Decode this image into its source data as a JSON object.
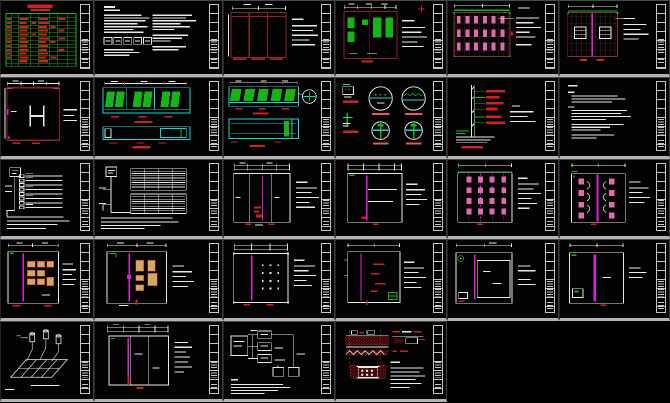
{
  "canvas": {
    "background": "#000000",
    "separator": "#b3b3b3",
    "cell_border": "#c6c6c6"
  },
  "palette": {
    "green": "#16b416",
    "red": "#d22020",
    "lightred": "#e8566a",
    "darkred": "#8a2424",
    "brown": "#7c3434",
    "pink": "#e06bb0",
    "magenta": "#e020d8",
    "cyan": "#1ad4d4",
    "tan": "#cfa968",
    "white": "#e8e8e8",
    "gray": "#c2c2c2",
    "sep": "#b3b3b3"
  },
  "sheets": [
    {
      "id": "r1c1",
      "name": "drawing-list-table",
      "kind": "table"
    },
    {
      "id": "r1c2",
      "name": "general-notes-sheet",
      "kind": "notes"
    },
    {
      "id": "r1c3",
      "name": "door-elevation",
      "kind": "elevation"
    },
    {
      "id": "r1c4",
      "name": "plan-with-green-fixtures",
      "kind": "plan"
    },
    {
      "id": "r1c5",
      "name": "ceiling-grid-plan-a",
      "kind": "ceiling"
    },
    {
      "id": "r1c6",
      "name": "ceiling-grid-plan-b",
      "kind": "ceiling"
    },
    {
      "id": "r2c1",
      "name": "room-plan-detail",
      "kind": "plan"
    },
    {
      "id": "r2c2",
      "name": "storefront-elevation-pair-a",
      "kind": "elevation"
    },
    {
      "id": "r2c3",
      "name": "storefront-elevation-pair-b",
      "kind": "elevation"
    },
    {
      "id": "r2c4",
      "name": "node-detail-circles",
      "kind": "detail"
    },
    {
      "id": "r2c5",
      "name": "wall-section-detail",
      "kind": "section"
    },
    {
      "id": "r2c6",
      "name": "specification-notes",
      "kind": "notes"
    },
    {
      "id": "r3c1",
      "name": "riser-diagram-a",
      "kind": "diagram"
    },
    {
      "id": "r3c2",
      "name": "riser-diagram-b",
      "kind": "diagram"
    },
    {
      "id": "r3c3",
      "name": "partition-plan-a",
      "kind": "plan"
    },
    {
      "id": "r3c4",
      "name": "partition-plan-b",
      "kind": "plan"
    },
    {
      "id": "r3c5",
      "name": "ceiling-fixture-plan-a",
      "kind": "ceiling"
    },
    {
      "id": "r3c6",
      "name": "ceiling-fixture-plan-b",
      "kind": "ceiling"
    },
    {
      "id": "r4c1",
      "name": "furniture-plan-a",
      "kind": "plan"
    },
    {
      "id": "r4c2",
      "name": "furniture-plan-b",
      "kind": "plan"
    },
    {
      "id": "r4c3",
      "name": "lighting-layout-plan",
      "kind": "plan"
    },
    {
      "id": "r4c4",
      "name": "annotated-plan",
      "kind": "plan"
    },
    {
      "id": "r4c5",
      "name": "room-layout-plan-a",
      "kind": "plan"
    },
    {
      "id": "r4c6",
      "name": "room-layout-plan-b",
      "kind": "plan"
    },
    {
      "id": "r5c1",
      "name": "axonometric-pipe-diagram",
      "kind": "isometric"
    },
    {
      "id": "r5c2",
      "name": "final-room-plan",
      "kind": "plan"
    },
    {
      "id": "r5c3",
      "name": "system-block-diagram",
      "kind": "diagram"
    },
    {
      "id": "r5c4",
      "name": "fixture-mounting-detail",
      "kind": "detail"
    }
  ]
}
